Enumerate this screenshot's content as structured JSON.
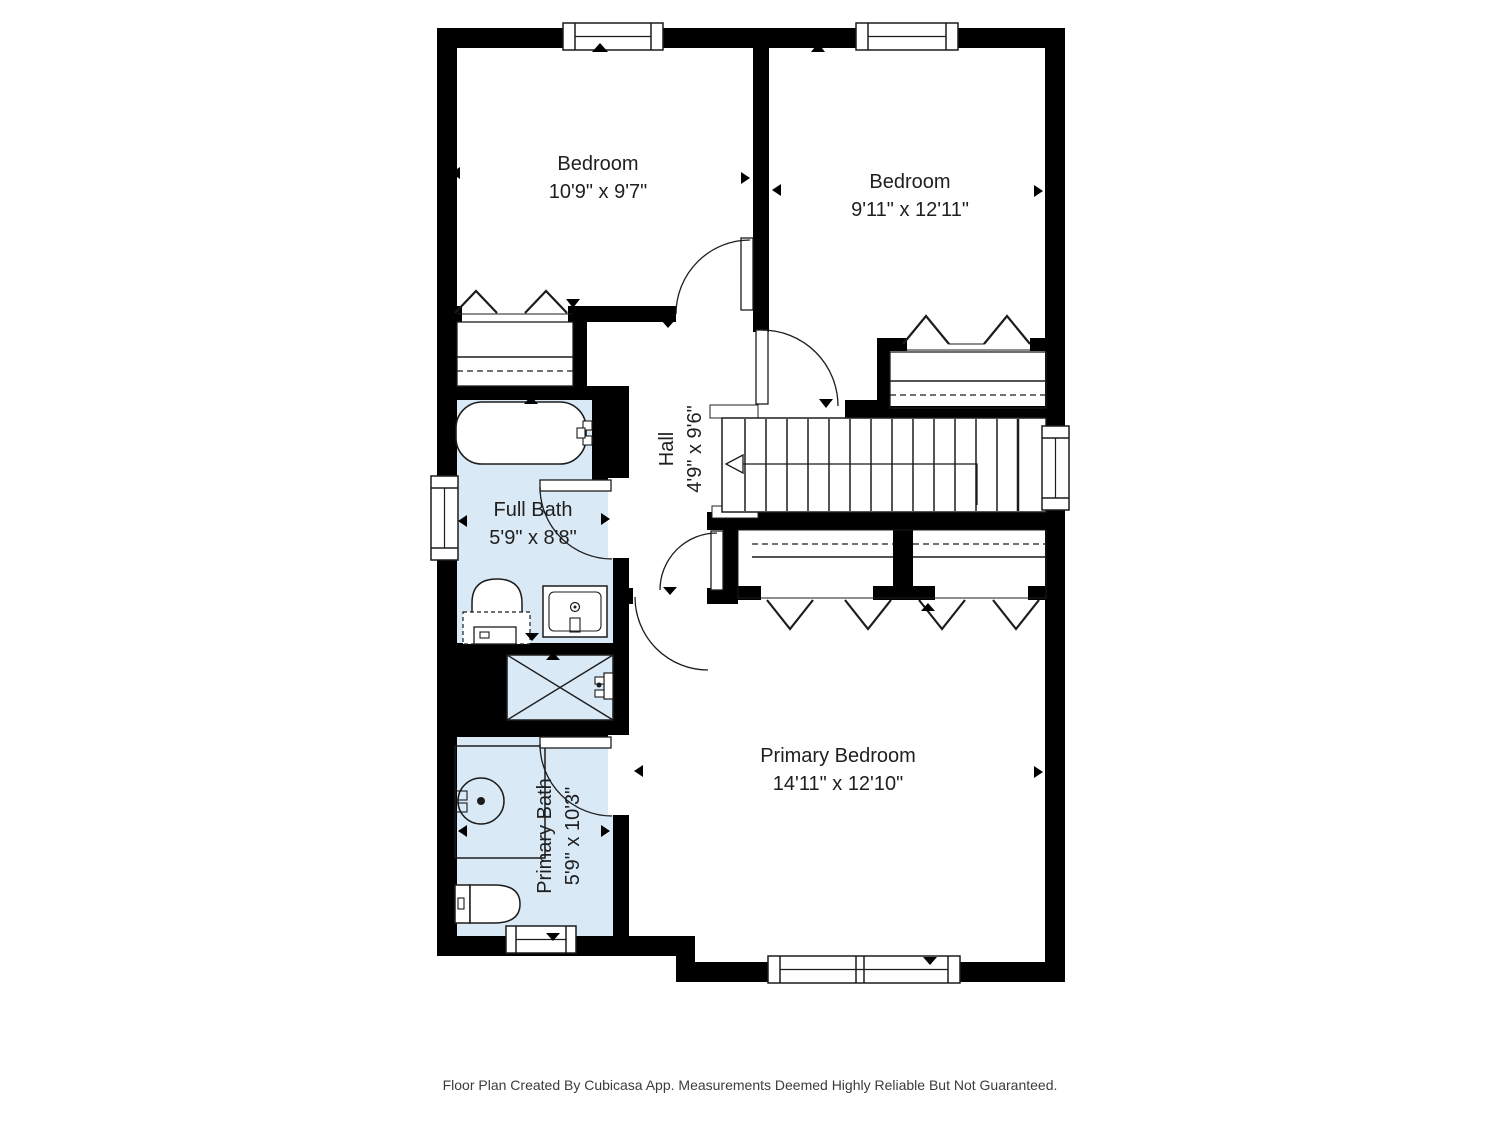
{
  "branding": {
    "footer_disclaimer": "Floor Plan Created By Cubicasa App. Measurements Deemed Highly Reliable But Not Guaranteed."
  },
  "palette": {
    "wall": "#000000",
    "bath_fill": "#d9e9f6",
    "line": "#1c1c1c",
    "text": "#1f1f1f",
    "footer_text": "#3c3c3c",
    "floor": "#ffffff"
  },
  "rooms": {
    "bedroom_left": {
      "label": "Bedroom",
      "dimensions": "10'9\" x 9'7\""
    },
    "bedroom_right": {
      "label": "Bedroom",
      "dimensions": "9'11\" x 12'11\""
    },
    "hall": {
      "label": "Hall",
      "dimensions": "4'9\" x 9'6\"",
      "text_rotation": "vertical"
    },
    "full_bath": {
      "label": "Full Bath",
      "dimensions": "5'9\" x 8'8\""
    },
    "primary_bath": {
      "label": "Primary Bath",
      "dimensions": "5'9\" x 10'3\"",
      "text_rotation": "vertical"
    },
    "primary_bedroom": {
      "label": "Primary Bedroom",
      "dimensions": "14'11\" x 12'10\""
    }
  },
  "symbols": {
    "fixtures": [
      "bathtub",
      "toilet",
      "sink",
      "shower",
      "vanity-round-sink",
      "closet-hangers"
    ],
    "stairs": "staircase-with-up-direction-arrow",
    "windows": 6,
    "doors": 6
  }
}
